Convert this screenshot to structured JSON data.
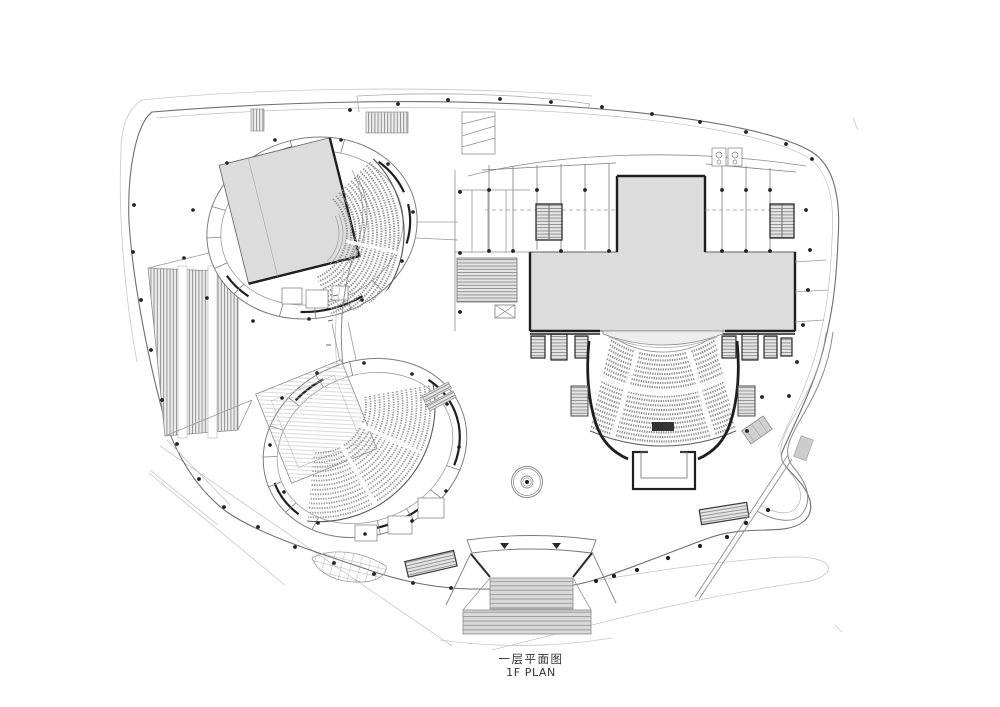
{
  "title": {
    "caption_zh": "一层平面图",
    "caption_en": "1F PLAN"
  },
  "palette": {
    "background": "#ffffff",
    "line_light": "#bdbdbd",
    "line_medium": "#8a8a8a",
    "line_dark": "#1f1f1f",
    "stage_fill": "#dcdcdc",
    "stair_fill": "#d9d9d9",
    "seat_stroke": "#8f8f8f",
    "text": "#333333"
  },
  "drawing": {
    "type": "architectural-floor-plan",
    "floor_label": "1F",
    "depicted_elements": [
      "site-boundary",
      "theatre-a-oval",
      "theatre-b-oval",
      "main-stage-house",
      "main-auditorium-seating",
      "orchestra-pit",
      "backstage-rooms",
      "exterior-stairs-west",
      "grand-entry-staircase",
      "information-desk",
      "plaza-benches",
      "planter",
      "escalators",
      "south-ramp"
    ]
  }
}
